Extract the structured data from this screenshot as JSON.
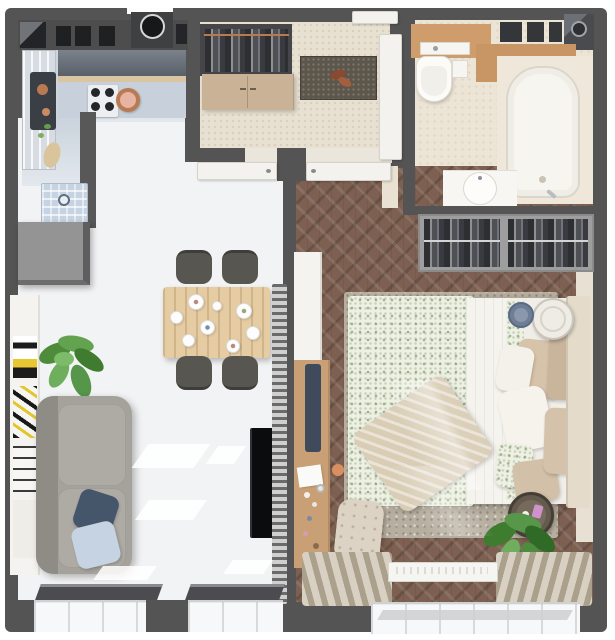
{
  "scene": {
    "title": "One-bedroom apartment — top-down 3D floor plan render",
    "view": "top-down orthographic 3D render, no visible text"
  },
  "palette": {
    "wall": "#545454",
    "floor-living": "#f2f3f5",
    "floor-kitchen": "#ccd5de",
    "floor-hall": "#e8e0d1",
    "floor-bath": "#ece4d5",
    "wood-floor": "#7d6051",
    "wood": "#cf9c6b",
    "worktop": "#c8d1db",
    "copper": "#b97a52",
    "sofa": "#a5a29c",
    "chair": "#575651",
    "table-wood": "#e6cca2",
    "navy": "#46566a",
    "light-blue": "#c5d3e2",
    "rug-bed": "#b6ae9f",
    "floral": "#eef0e2",
    "curtain": "#cbc2b1",
    "tv": "#0b0c0d",
    "plant": "#58974a"
  },
  "rooms": {
    "kitchen": {
      "label": "Kitchen",
      "items": [
        "upper cabinets row",
        "cooker hood",
        "gas hob with copper pan",
        "dark sink unit with copper kettle",
        "tall glass cabinet",
        "L-shaped worktop",
        "blue runner rug with medallion",
        "grey peninsula divider"
      ]
    },
    "hallway": {
      "label": "Entrance hall",
      "items": [
        "front door",
        "open coat closet with copper rail",
        "beige shoe cabinet",
        "speckled doormat with leaf decor"
      ]
    },
    "bathroom": {
      "label": "Bathroom",
      "items": [
        "washing machine",
        "wall niches",
        "wooden vanity shelf",
        "toilet with flush lid",
        "paper box",
        "bathtub",
        "round washbasin counter",
        "white door"
      ]
    },
    "living_room": {
      "label": "Living room",
      "items": [
        "grey sideboard",
        "art shelf with prints",
        "potted plant",
        "grey two-seat sofa",
        "navy cushion",
        "light-blue cushion",
        "wooden dining table with tableware",
        "four grey chairs",
        "wall-mounted TV",
        "slatted screen radiator",
        "two dark window sills",
        "balcony glazing"
      ]
    },
    "bedroom": {
      "label": "Bedroom",
      "items": [
        "open closet with hanging clothes",
        "double bed with green floral bedding",
        "beige knitted throw",
        "pillows",
        "light headboard",
        "round white nightstand",
        "blue-grey basket",
        "dark round side table",
        "white wardrobe",
        "wooden dressing table with cosmetics",
        "navy bench",
        "tufted ottoman",
        "melange area rug",
        "herringbone parquet",
        "pleated curtains",
        "white window sill",
        "potted plant"
      ]
    }
  },
  "doors": {
    "front_door": "top of entrance hall",
    "living_door": "open leaf against hall wall",
    "bedroom_door": "open leaf against hall wall",
    "bathroom_door": "white leaf on hallway wall"
  }
}
